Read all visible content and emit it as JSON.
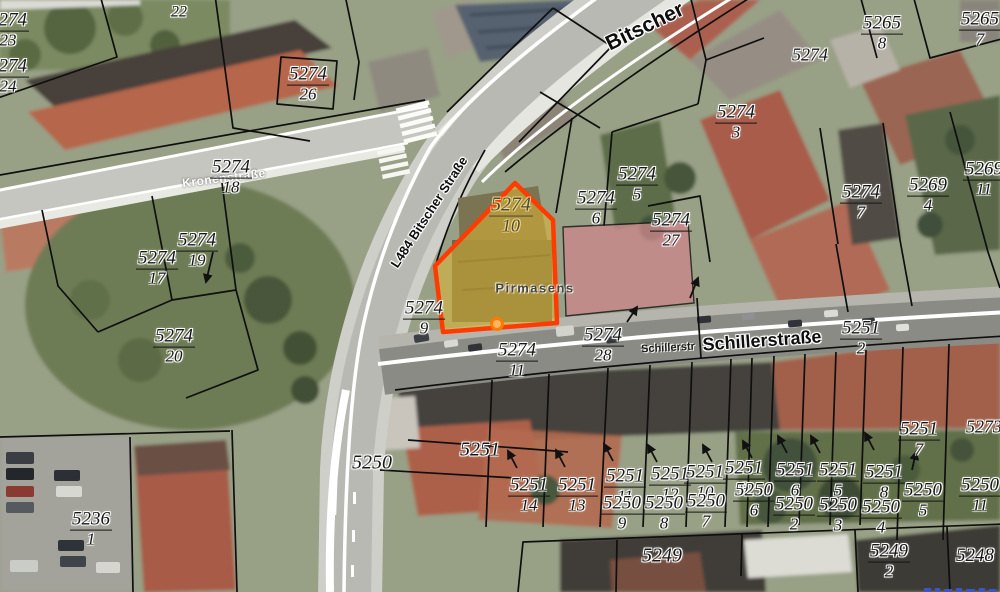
{
  "map": {
    "kind": "cadastral-parcel-map-over-aerial-imagery",
    "city_label": "Pirmasens",
    "highlight": {
      "parcel_numerator": "5274",
      "parcel_denominator": "10",
      "border_color": "#ff3b00",
      "fill_color": "#e3b92f",
      "marker_color": "#ff7a00"
    },
    "street_labels": [
      {
        "t": "Bitscher",
        "x": 645,
        "y": 27,
        "size": 21,
        "rot": -26,
        "style": "road"
      },
      {
        "t": "L484 Bitscher Straße",
        "x": 429,
        "y": 212,
        "size": 13,
        "rot": -57,
        "style": "road"
      },
      {
        "t": "Kronenstraße",
        "x": 224,
        "y": 178,
        "size": 12,
        "rot": -7,
        "style": "white"
      },
      {
        "t": "Schillerstr",
        "x": 668,
        "y": 348,
        "size": 11,
        "rot": -3,
        "style": "road-small"
      },
      {
        "t": "Schillerstraße",
        "x": 762,
        "y": 341,
        "size": 18,
        "rot": -4,
        "style": "road"
      },
      {
        "t": "Pirmasens",
        "x": 535,
        "y": 288,
        "size": 13,
        "rot": 0,
        "style": "city"
      }
    ],
    "parcel_labels": [
      {
        "n": "5274",
        "d": "23",
        "x": 8,
        "y": 30
      },
      {
        "n": "5274",
        "d": "24",
        "x": 8,
        "y": 76
      },
      {
        "n": "5274",
        "d": "26",
        "x": 308,
        "y": 84
      },
      {
        "n": "5274",
        "d": "18",
        "x": 231,
        "y": 177
      },
      {
        "n": "5274",
        "d": "19",
        "x": 197,
        "y": 250
      },
      {
        "n": "5274",
        "d": "17",
        "x": 157,
        "y": 268
      },
      {
        "n": "5274",
        "d": "20",
        "x": 174,
        "y": 346
      },
      {
        "n": "5274",
        "d": "9",
        "x": 424,
        "y": 318
      },
      {
        "n": "5274",
        "d": "11",
        "x": 517,
        "y": 360
      },
      {
        "n": "5274",
        "d": "28",
        "x": 603,
        "y": 345
      },
      {
        "n": "5274",
        "d": "6",
        "x": 596,
        "y": 208
      },
      {
        "n": "5274",
        "d": "5",
        "x": 637,
        "y": 184
      },
      {
        "n": "5274",
        "d": "27",
        "x": 671,
        "y": 230
      },
      {
        "n": "5274",
        "d": "3",
        "x": 736,
        "y": 122
      },
      {
        "n": "5274",
        "d": "7",
        "x": 861,
        "y": 202
      },
      {
        "n": "5269",
        "d": "4",
        "x": 928,
        "y": 195
      },
      {
        "n": "5269",
        "d": "11",
        "x": 984,
        "y": 179
      },
      {
        "n": "5265",
        "d": "8",
        "x": 882,
        "y": 33
      },
      {
        "n": "5265",
        "d": "7",
        "x": 980,
        "y": 29
      },
      {
        "n": "5251",
        "d": "2",
        "x": 861,
        "y": 338
      },
      {
        "n": "5236",
        "d": "1",
        "x": 91,
        "y": 529
      },
      {
        "n": "5251",
        "d": "14",
        "x": 529,
        "y": 495
      },
      {
        "n": "5251",
        "d": "13",
        "x": 577,
        "y": 495
      },
      {
        "n": "5251",
        "d": "11",
        "x": 625,
        "y": 486
      },
      {
        "n": "5251",
        "d": "12",
        "x": 670,
        "y": 484
      },
      {
        "n": "5251",
        "d": "10",
        "x": 705,
        "y": 482
      },
      {
        "n": "5251",
        "d": "9",
        "x": 744,
        "y": 478
      },
      {
        "n": "5251",
        "d": "6",
        "x": 795,
        "y": 480
      },
      {
        "n": "5251",
        "d": "5",
        "x": 838,
        "y": 480
      },
      {
        "n": "5251",
        "d": "8",
        "x": 884,
        "y": 482
      },
      {
        "n": "5251",
        "d": "7",
        "x": 919,
        "y": 439
      },
      {
        "n": "5250",
        "d": "6",
        "x": 754,
        "y": 500
      },
      {
        "n": "5250",
        "d": "9",
        "x": 622,
        "y": 513
      },
      {
        "n": "5250",
        "d": "8",
        "x": 664,
        "y": 513
      },
      {
        "n": "5250",
        "d": "7",
        "x": 706,
        "y": 511
      },
      {
        "n": "5250",
        "d": "2",
        "x": 794,
        "y": 514
      },
      {
        "n": "5250",
        "d": "3",
        "x": 838,
        "y": 515
      },
      {
        "n": "5250",
        "d": "4",
        "x": 881,
        "y": 517
      },
      {
        "n": "5250",
        "d": "5",
        "x": 923,
        "y": 500
      },
      {
        "n": "5250",
        "d": "11",
        "x": 980,
        "y": 495
      },
      {
        "n": "5249",
        "d": "2",
        "x": 889,
        "y": 561
      },
      {
        "n": "5274",
        "d": "10",
        "x": 511,
        "y": 215,
        "size": 20,
        "style": "highlight"
      }
    ],
    "single_labels": [
      {
        "t": "22",
        "x": 179,
        "y": 13,
        "size": 16
      },
      {
        "t": "5274",
        "x": 810,
        "y": 55,
        "size": 18
      },
      {
        "t": "5273",
        "x": 984,
        "y": 427,
        "size": 18
      },
      {
        "t": "5250",
        "x": 372,
        "y": 463,
        "size": 20
      },
      {
        "t": "5251",
        "x": 480,
        "y": 450,
        "size": 20
      },
      {
        "t": "5249",
        "x": 662,
        "y": 556,
        "size": 20
      },
      {
        "t": "5248",
        "x": 975,
        "y": 556,
        "size": 19
      }
    ],
    "arrows": [
      [
        213,
        252,
        206,
        282
      ],
      [
        690,
        298,
        698,
        278
      ],
      [
        627,
        322,
        637,
        307
      ],
      [
        517,
        468,
        508,
        451
      ],
      [
        565,
        467,
        556,
        450
      ],
      [
        613,
        461,
        604,
        444
      ],
      [
        657,
        462,
        648,
        445
      ],
      [
        712,
        462,
        703,
        445
      ],
      [
        752,
        458,
        743,
        441
      ],
      [
        787,
        453,
        778,
        436
      ],
      [
        820,
        453,
        811,
        436
      ],
      [
        874,
        450,
        865,
        433
      ],
      [
        912,
        470,
        916,
        452
      ]
    ]
  }
}
